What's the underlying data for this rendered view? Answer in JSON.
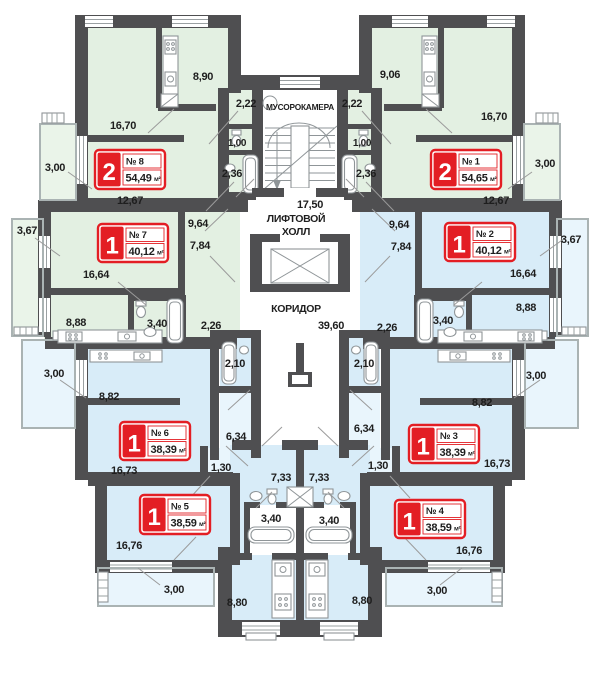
{
  "plan_type": "residential-floor-plan",
  "colors": {
    "wall": "#4f4f51",
    "zone_green": "#e3f0e2",
    "zone_blue": "#d8ecf8",
    "zone_pale": "#e9f5fc",
    "badge_red": "#e31e24",
    "text": "#1e1e1e",
    "thin_line": "#9b9b9b"
  },
  "core": {
    "trash_room": "МУСОРОКАМЕРА",
    "elevator_hall_area": "17,50",
    "elevator_hall_line1": "ЛИФТОВОЙ",
    "elevator_hall_line2": "ХОЛЛ",
    "corridor": "КОРИДОР",
    "corridor_area": "39,60"
  },
  "apartments": [
    {
      "key": "8",
      "rooms": "2",
      "number": "№ 8",
      "area": "54,49",
      "unit": "м²",
      "zone": "green"
    },
    {
      "key": "1",
      "rooms": "2",
      "number": "№ 1",
      "area": "54,65",
      "unit": "м²",
      "zone": "green"
    },
    {
      "key": "7",
      "rooms": "1",
      "number": "№ 7",
      "area": "40,12",
      "unit": "м²",
      "zone": "green"
    },
    {
      "key": "2",
      "rooms": "1",
      "number": "№ 2",
      "area": "40,12",
      "unit": "м²",
      "zone": "blue"
    },
    {
      "key": "6",
      "rooms": "1",
      "number": "№ 6",
      "area": "38,39",
      "unit": "м²",
      "zone": "blue"
    },
    {
      "key": "3",
      "rooms": "1",
      "number": "№ 3",
      "area": "38,39",
      "unit": "м²",
      "zone": "blue"
    },
    {
      "key": "5",
      "rooms": "1",
      "number": "№ 5",
      "area": "38,59",
      "unit": "м²",
      "zone": "blue"
    },
    {
      "key": "4",
      "rooms": "1",
      "number": "№ 4",
      "area": "38,59",
      "unit": "м²",
      "zone": "blue"
    }
  ],
  "dims": {
    "a8": {
      "kitchen": "8,90",
      "hall": "2,22",
      "living": "16,70",
      "wc": "1,00",
      "bath": "2,36",
      "balcony": "3,00",
      "bedroom": "12,67"
    },
    "a1": {
      "kitchen": "9,06",
      "hall": "2,22",
      "living": "16,70",
      "wc": "1,00",
      "bath": "2,36",
      "balcony": "3,00",
      "bedroom": "12,67"
    },
    "a7": {
      "balcony": "3,67",
      "hall1": "9,64",
      "hall2": "7,84",
      "living": "16,64",
      "kitchen": "8,88",
      "bath": "3,40",
      "hall3": "2,26"
    },
    "a2": {
      "balcony": "3,67",
      "hall1": "9,64",
      "hall2": "7,84",
      "living": "16,64",
      "kitchen": "8,88",
      "bath": "3,40",
      "hall3": "2,26"
    },
    "a6": {
      "kitchen": "8,82",
      "living": "16,73",
      "bath": "2,10",
      "hall1": "6,34",
      "hall2": "1,30",
      "balcony": "3,00"
    },
    "a3": {
      "kitchen": "8,82",
      "living": "16,73",
      "bath": "2,10",
      "hall1": "6,34",
      "hall2": "1,30",
      "balcony": "3,00"
    },
    "a5": {
      "living": "16,76",
      "hall": "7,33",
      "bath": "3,40",
      "kitchen": "8,80",
      "balcony": "3,00"
    },
    "a4": {
      "living": "16,76",
      "hall": "7,33",
      "bath": "3,40",
      "kitchen": "8,80",
      "balcony": "3,00"
    }
  }
}
